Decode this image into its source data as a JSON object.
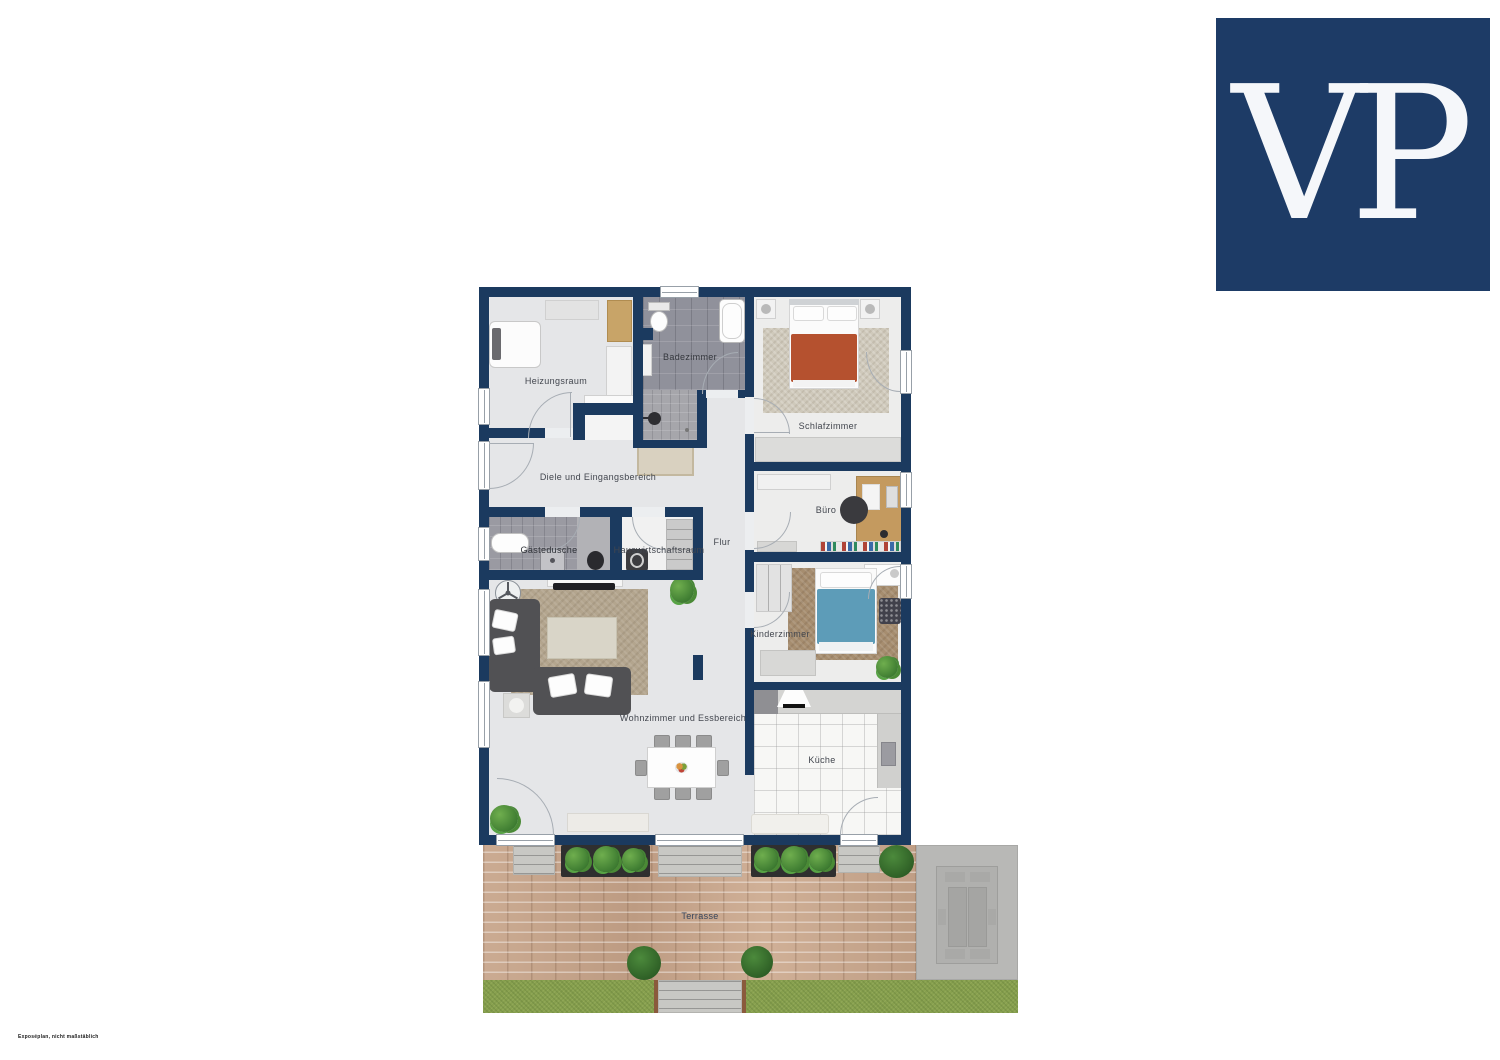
{
  "page": {
    "background": "#ffffff"
  },
  "logo": {
    "text": "VP",
    "letters": [
      "V",
      "P"
    ],
    "bg": "#1d3b66",
    "fg": "#f5f7fa"
  },
  "disclaimer": "Exposéplan, nicht maßstäblich",
  "floorplan": {
    "labels": {
      "heizungsraum": "Heizungsraum",
      "badezimmer": "Badezimmer",
      "schlafzimmer": "Schlafzimmer",
      "diele": "Diele und Eingangsbereich",
      "buero": "Büro",
      "gaestedusche": "Gästedusche",
      "hauswirtschaftsraum": "Hauswirtschaftsraum",
      "flur": "Flur",
      "kinderzimmer": "Kinderzimmer",
      "wohnzimmer": "Wohnzimmer und Essbereich",
      "kueche": "Küche",
      "terrasse": "Terrasse"
    },
    "colors": {
      "wall": "#1b3a5f",
      "floor": "#e5e6e8",
      "bath_tile": "#90919b",
      "kitchen_tile": "#f7f7f5",
      "bed_blanket": "#b5512f",
      "kid_bed_blanket": "#5d9cb8",
      "sofa": "#515154",
      "rug_living": "#b3a58e",
      "brick": "#c5a189",
      "grass": "#87a04e",
      "patio": "#b8b8b6"
    }
  }
}
